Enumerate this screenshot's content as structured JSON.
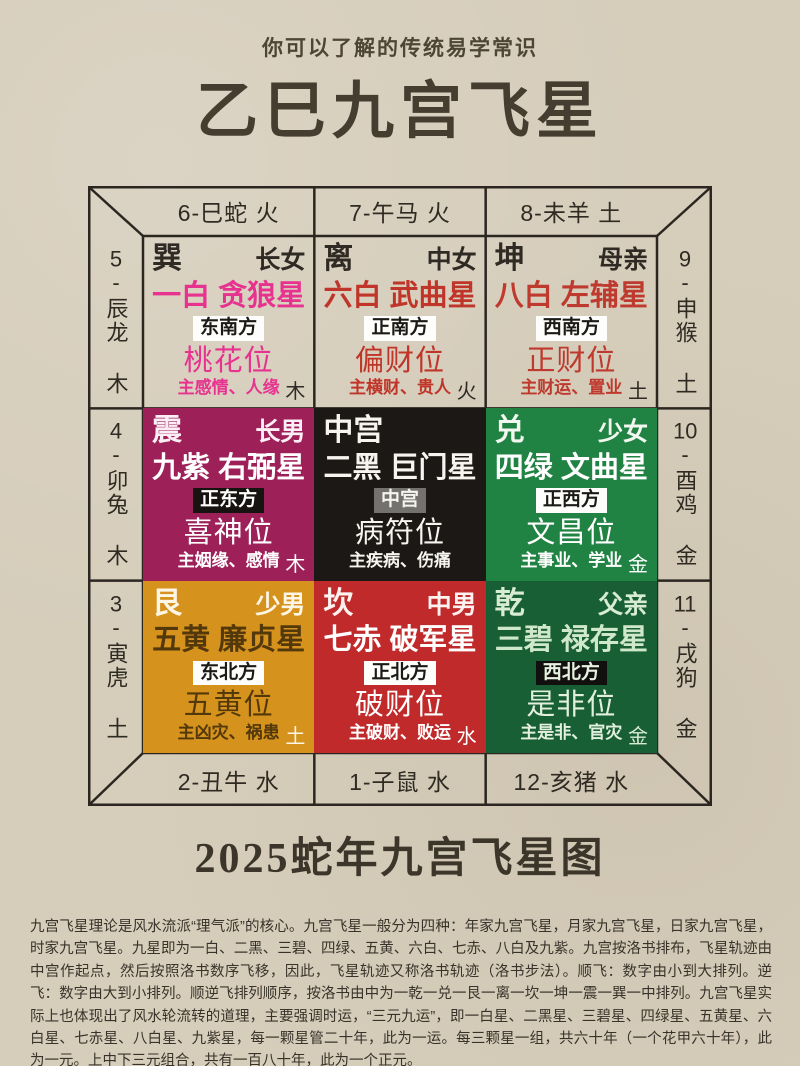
{
  "theme": {
    "paper": "#d6cdbb",
    "line": "#2b2620",
    "ink": "#2f2a22",
    "title-ink": "#443d30"
  },
  "page": {
    "subtitle": "你可以了解的传统易学常识",
    "title": "乙巳九宫飞星",
    "footer_title": "2025蛇年九宫飞星图",
    "paragraph": "九宫飞星理论是风水流派“理气派”的核心。九宫飞星一般分为四种：年家九宫飞星，月家九宫飞星，日家九宫飞星，时家九宫飞星。九星即为一白、二黑、三碧、四绿、五黄、六白、七赤、八白及九紫。九宫按洛书排布，飞星轨迹由中宫作起点，然后按照洛书数序飞移，因此，飞星轨迹又称洛书轨迹（洛书步法）。顺飞：数字由小到大排列。逆飞：数字由大到小排列。顺逆飞排列顺序，按洛书由中为一乾一兑一艮一离一坎一坤一震一巽一中排列。九宫飞星实际上也体现出了风水轮流转的道理，主要强调时运，“三元九运”，即一白星、二黑星、三碧星、四绿星、五黄星、六白星、七赤星、八白星、九紫星，每一颗星管二十年，此为一运。每三颗星一组，共六十年（一个花甲六十年），此为一元。上中下三元组合，共有一百八十年，此为一个正元。"
  },
  "frame": {
    "top": [
      "6-巳蛇 火",
      "7-午马 火",
      "8-未羊 土"
    ],
    "bottom": [
      "2-丑牛 水",
      "1-子鼠 水",
      "12-亥猪 水"
    ],
    "left": [
      {
        "num": "5",
        "rest": "-辰龙 木"
      },
      {
        "num": "4",
        "rest": "-卯兔 木"
      },
      {
        "num": "3",
        "rest": "-寅虎 土"
      }
    ],
    "right": [
      {
        "num": "9",
        "rest": "-申猴 土"
      },
      {
        "num": "10",
        "rest": "-酉鸡 金"
      },
      {
        "num": "11",
        "rest": "-戌狗 金"
      }
    ]
  },
  "cells": [
    {
      "trigram": "巽",
      "member": "长女",
      "star": "一白 贪狼星",
      "direction": "东南方",
      "position": "桃花位",
      "meaning": "主感情、人缘",
      "element": "木",
      "colors": {
        "bg": "transparent",
        "head": "#2f2a23",
        "star": "#e7338f",
        "badge_bg": "#fdfdfb",
        "badge_tx": "#1c1a17",
        "accent": "#e7338f",
        "elem": "#2f2a23"
      }
    },
    {
      "trigram": "离",
      "member": "中女",
      "star": "六白 武曲星",
      "direction": "正南方",
      "position": "偏财位",
      "meaning": "主横财、贵人",
      "element": "火",
      "colors": {
        "bg": "transparent",
        "head": "#2f2a23",
        "star": "#c03529",
        "badge_bg": "#fdfdfb",
        "badge_tx": "#1c1a17",
        "accent": "#c03529",
        "elem": "#2f2a23"
      }
    },
    {
      "trigram": "坤",
      "member": "母亲",
      "star": "八白 左辅星",
      "direction": "西南方",
      "position": "正财位",
      "meaning": "主财运、置业",
      "element": "土",
      "colors": {
        "bg": "transparent",
        "head": "#2f2a23",
        "star": "#bf3a2e",
        "badge_bg": "#fdfdfb",
        "badge_tx": "#1c1a17",
        "accent": "#bf3a2e",
        "elem": "#2f2a23"
      }
    },
    {
      "trigram": "震",
      "member": "长男",
      "star": "九紫 右弼星",
      "direction": "正东方",
      "position": "喜神位",
      "meaning": "主姻缘、感情",
      "element": "木",
      "colors": {
        "bg": "#9d2058",
        "head": "#fceef5",
        "star": "#ffffff",
        "badge_bg": "#171310",
        "badge_tx": "#ffffff",
        "accent": "#ffffff",
        "elem": "#ffffff"
      }
    },
    {
      "trigram": "中宫",
      "member": "",
      "star": "二黑 巨门星",
      "direction": "中宫",
      "position": "病符位",
      "meaning": "主疾病、伤痛",
      "element": "",
      "colors": {
        "bg": "#1b1815",
        "head": "#f6f4ef",
        "star": "#f6f4ef",
        "badge_bg": "#73726e",
        "badge_tx": "#f6f4ef",
        "accent": "#f6f4ef",
        "elem": "#f6f4ef"
      }
    },
    {
      "trigram": "兑",
      "member": "少女",
      "star": "四绿 文曲星",
      "direction": "正西方",
      "position": "文昌位",
      "meaning": "主事业、学业",
      "element": "金",
      "colors": {
        "bg": "#218343",
        "head": "#f2f8f0",
        "star": "#ffffff",
        "badge_bg": "#fdfdfb",
        "badge_tx": "#1c1a17",
        "accent": "#ffffff",
        "elem": "#ffffff"
      }
    },
    {
      "trigram": "艮",
      "member": "少男",
      "star": "五黄 廉贞星",
      "direction": "东北方",
      "position": "五黄位",
      "meaning": "主凶灾、祸患",
      "element": "土",
      "colors": {
        "bg": "#d5921c",
        "head": "#fdf6e6",
        "star": "#53380b",
        "badge_bg": "#fdfdfb",
        "badge_tx": "#1c1a17",
        "accent": "#53380b",
        "elem": "#fdf6e6"
      }
    },
    {
      "trigram": "坎",
      "member": "中男",
      "star": "七赤 破军星",
      "direction": "正北方",
      "position": "破财位",
      "meaning": "主破财、败运",
      "element": "水",
      "colors": {
        "bg": "#c02a2a",
        "head": "#fdf2f0",
        "star": "#ffffff",
        "badge_bg": "#fdfdfb",
        "badge_tx": "#1c1a17",
        "accent": "#ffffff",
        "elem": "#ffffff"
      }
    },
    {
      "trigram": "乾",
      "member": "父亲",
      "star": "三碧 禄存星",
      "direction": "西北方",
      "position": "是非位",
      "meaning": "主是非、官灾",
      "element": "金",
      "colors": {
        "bg": "#195f36",
        "head": "#d8ecd3",
        "star": "#cfe8cb",
        "badge_bg": "#12100e",
        "badge_tx": "#e6f1e1",
        "accent": "#e3f0de",
        "elem": "#d8ecd3"
      }
    }
  ]
}
